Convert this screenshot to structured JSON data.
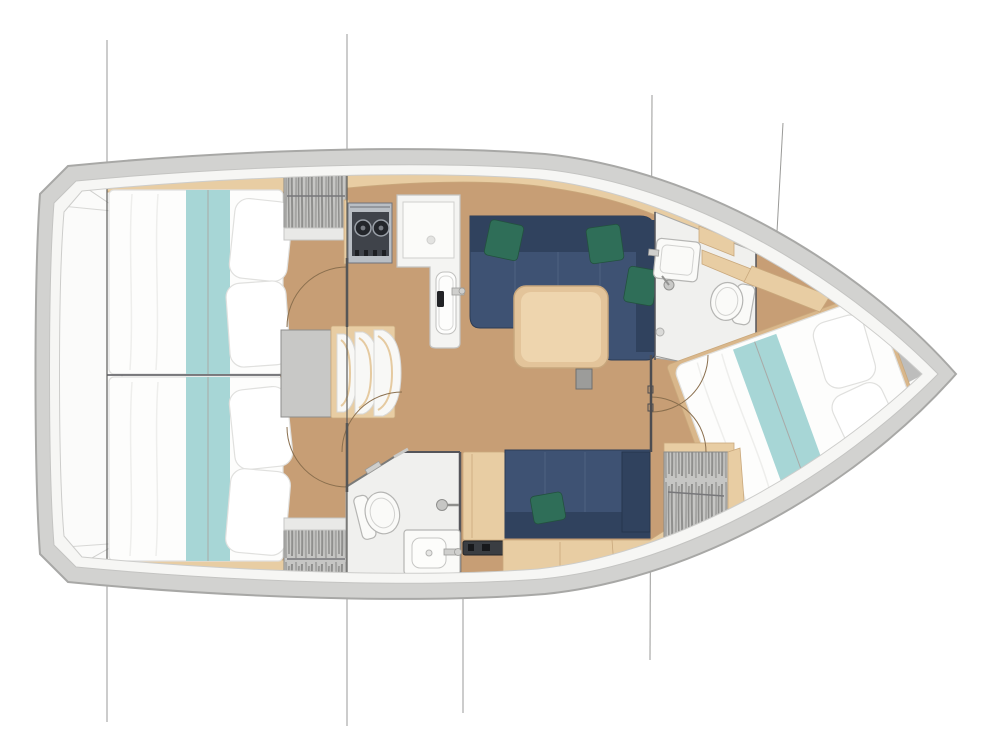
{
  "meta": {
    "description": "Top-down interior layout plan of a sailing yacht: two aft double cabins, galley, saloon with U-sofa and table, two heads with shower and toilet, starboard settee, companionway steps and forward V-berth cabin"
  },
  "plan": {
    "caption": "Sailboat interior floor plan",
    "rooms": [
      {
        "id": "aft-cabin-port",
        "features": [
          "double-bed",
          "teal-runner",
          "pillows",
          "hanging-locker",
          "door"
        ]
      },
      {
        "id": "aft-cabin-starboard",
        "features": [
          "double-bed",
          "teal-runner",
          "pillows",
          "hanging-locker",
          "door"
        ]
      },
      {
        "id": "galley",
        "features": [
          "two-burner-stove",
          "worktop",
          "sink",
          "faucet"
        ]
      },
      {
        "id": "saloon",
        "features": [
          "navy-sofa",
          "green-cushions",
          "wood-table",
          "table-pedestal"
        ]
      },
      {
        "id": "forward-head",
        "features": [
          "wash-basin",
          "toilet",
          "shower-mixer",
          "shower-drain"
        ]
      },
      {
        "id": "aft-head",
        "features": [
          "toilet",
          "wash-basin",
          "shower-mixer",
          "towel-bar"
        ]
      },
      {
        "id": "starboard-settee",
        "features": [
          "navy-bench",
          "green-cushion",
          "stowage-lockers"
        ]
      },
      {
        "id": "forward-cabin",
        "features": [
          "v-berth-bed",
          "teal-runner",
          "pillows",
          "hanging-locker",
          "shelf"
        ]
      },
      {
        "id": "companionway",
        "features": [
          "three-steps",
          "engine-hatch-landing"
        ]
      },
      {
        "id": "transom",
        "features": [
          "swim-platform"
        ]
      }
    ],
    "section_lines": 5
  },
  "colors": {
    "hull_shell": "#d2d2d0",
    "hull_outline": "#a8a8a6",
    "deck_white": "#f6f6f4",
    "deck_line": "#c4c4c2",
    "interior_white": "#fbfbfa",
    "floor_wood": "#c79e75",
    "wood_light": "#e8cda3",
    "wood_dark": "#c9a87c",
    "bed_white": "#fdfdfc",
    "bed_line": "#e0e0de",
    "teal": "#a7d6d6",
    "navy": "#3e5273",
    "navy_dark": "#30425e",
    "navy_edge": "#2c3c55",
    "green": "#2f6e58",
    "green_dark": "#23513f",
    "locker_gray": "#c6c6c4",
    "locker_stripe": "#8f8f8d",
    "bath_floor": "#f0f0ee",
    "fixture_white": "#fafaf8",
    "fixture_line": "#b5b5b3",
    "fixture_inner": "#d2d2d0",
    "metal_gray": "#cfcfcd",
    "stove_metal": "#b9bec4",
    "stove_dark": "#3f434a",
    "burner_black": "#23262b",
    "landing_gray": "#c8c8c6",
    "wall_dark": "#55555a",
    "section_line": "#9a9a98",
    "arc_line": "#8a6f4e",
    "pedestal_gray": "#9c9c9a",
    "shadow_gray": "#b2b2b0",
    "table_wood": "#e3c49a",
    "table_light": "#eed5ae"
  }
}
